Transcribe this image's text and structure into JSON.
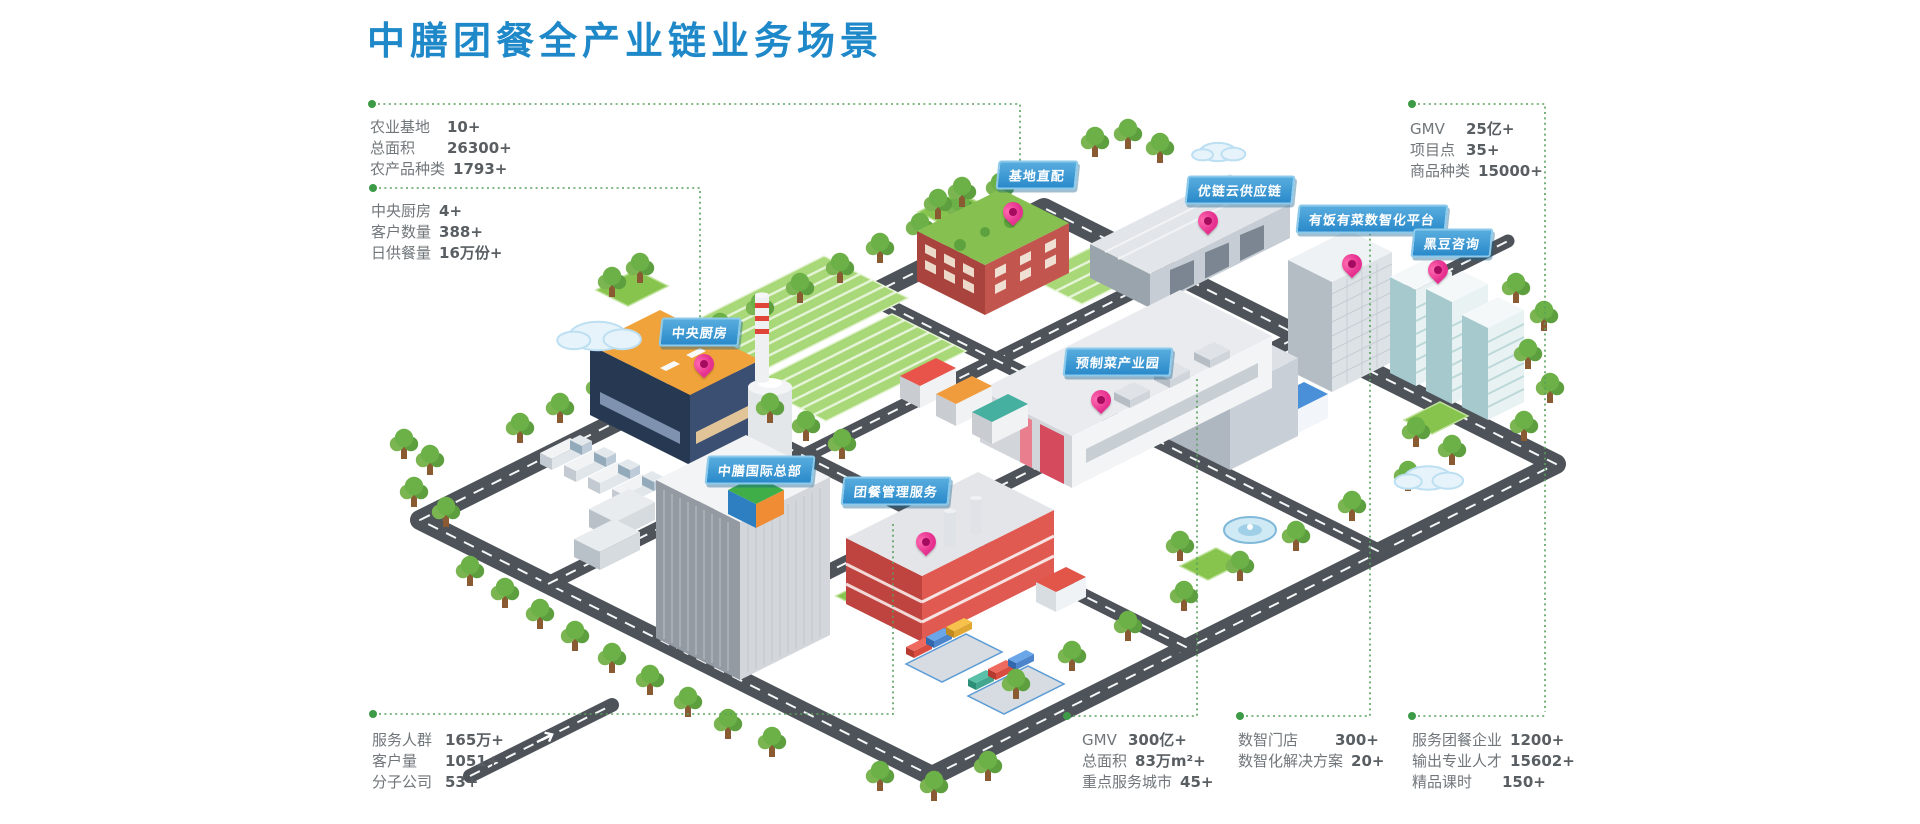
{
  "title": "中膳团餐全产业链业务场景",
  "colors": {
    "accent": "#1e88c9",
    "pill_blue": "#2a8aca",
    "pin_magenta": "#e5308f",
    "connector_green": "#58a05c"
  },
  "map_labels": [
    {
      "text": "中央厨房"
    },
    {
      "text": "基地直配"
    },
    {
      "text": "优链云供应链"
    },
    {
      "text": "有饭有菜数智化平台"
    },
    {
      "text": "黑豆咨询"
    },
    {
      "text": "预制菜产业园"
    },
    {
      "text": "中膳国际总部"
    },
    {
      "text": "团餐管理服务"
    }
  ],
  "stats_blocks": [
    {
      "id": "agriculture-base",
      "rows": [
        {
          "label": "农业基地",
          "value": "10+"
        },
        {
          "label": "总面积",
          "value": "26300+"
        },
        {
          "label": "农产品种类",
          "value": "1793+"
        }
      ]
    },
    {
      "id": "central-kitchen",
      "rows": [
        {
          "label": "中央厨房",
          "value": "4+"
        },
        {
          "label": "客户数量",
          "value": "388+"
        },
        {
          "label": "日供餐量",
          "value": "16万份+"
        }
      ]
    },
    {
      "id": "gmv-top",
      "rows": [
        {
          "label": "GMV",
          "value": "25亿+"
        },
        {
          "label": "项目点",
          "value": "35+"
        },
        {
          "label": "商品种类",
          "value": "15000+"
        }
      ]
    },
    {
      "id": "service-population",
      "rows": [
        {
          "label": "服务人群",
          "value": "165万+"
        },
        {
          "label": "客户量",
          "value": "1051+"
        },
        {
          "label": "分子公司",
          "value": "53+"
        }
      ]
    },
    {
      "id": "gmv-bottom",
      "rows": [
        {
          "label": "GMV",
          "value": "300亿+"
        },
        {
          "label": "总面积",
          "value": "83万m²+"
        },
        {
          "label": "重点服务城市",
          "value": "45+"
        }
      ]
    },
    {
      "id": "digital-stores",
      "rows": [
        {
          "label": "数智门店",
          "value": "300+"
        },
        {
          "label": "数智化解决方案",
          "value": "20+"
        }
      ]
    },
    {
      "id": "talent-output",
      "rows": [
        {
          "label": "服务团餐企业",
          "value": "1200+"
        },
        {
          "label": "输出专业人才",
          "value": "15602+"
        },
        {
          "label": "精品课时",
          "value": "150+"
        }
      ]
    }
  ]
}
